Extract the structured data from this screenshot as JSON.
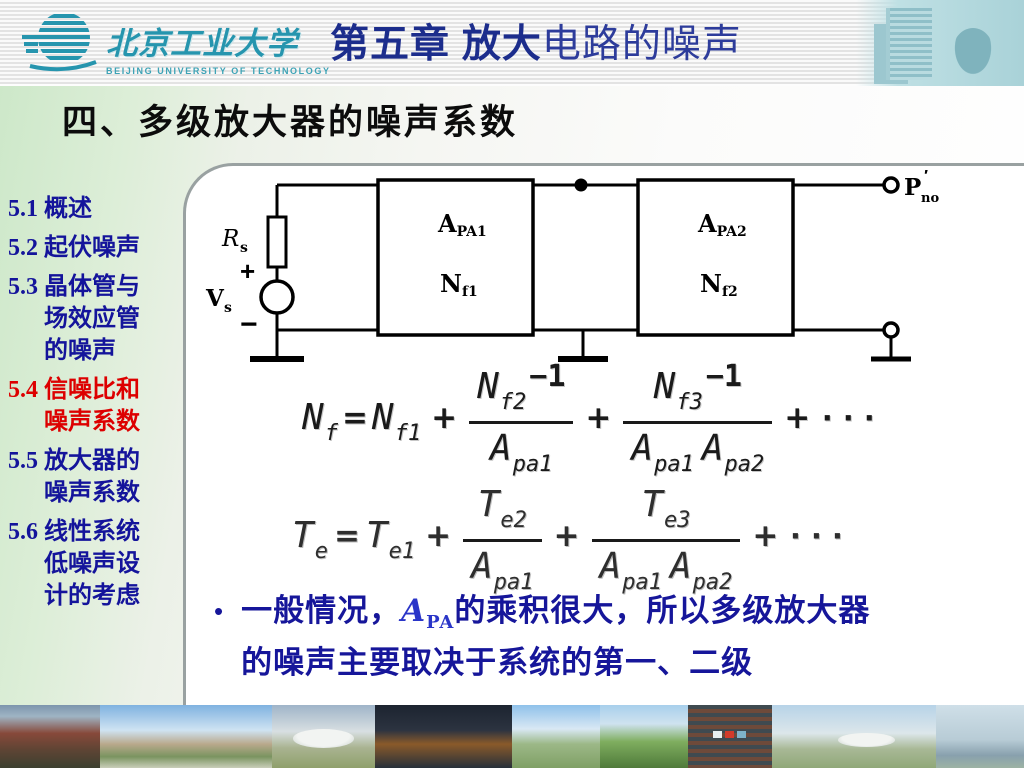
{
  "header": {
    "university_cn": "北京工业大学",
    "university_en": "BEIJING UNIVERSITY OF TECHNOLOGY",
    "chapter_title_bold": "第五章 放大",
    "chapter_title_rest": "电路的噪声"
  },
  "slide": {
    "title": "四、多级放大器的噪声系数"
  },
  "sidebar": {
    "normal_color": "#14149b",
    "active_color": "#dd0000",
    "items": [
      {
        "num": "5.1",
        "lines": [
          "概述"
        ],
        "active": false
      },
      {
        "num": "5.2",
        "lines": [
          "起伏噪声"
        ],
        "active": false
      },
      {
        "num": "5.3",
        "lines": [
          "晶体管与",
          "场效应管",
          "的噪声"
        ],
        "active": false
      },
      {
        "num": "5.4",
        "lines": [
          "信噪比和",
          "噪声系数"
        ],
        "active": true
      },
      {
        "num": "5.5",
        "lines": [
          "放大器的",
          "噪声系数"
        ],
        "active": false
      },
      {
        "num": "5.6",
        "lines": [
          "线性系统",
          "低噪声设",
          "计的考虑"
        ],
        "active": false
      }
    ]
  },
  "circuit": {
    "rs": "R",
    "rs_sub": "s",
    "vs": "V",
    "vs_sub": "s",
    "plus": "+",
    "minus": "−",
    "amp1_gain": "A",
    "amp1_gain_sub": "PA1",
    "amp1_nf": "N",
    "amp1_nf_sub": "f1",
    "amp2_gain": "A",
    "amp2_gain_sub": "PA2",
    "amp2_nf": "N",
    "amp2_nf_sub": "f2",
    "out": "P",
    "out_prime": "′",
    "out_sub": "no"
  },
  "formulas": {
    "nf": {
      "lhs": "N",
      "lhs_sub": "f",
      "eq": "=",
      "t1": "N",
      "t1_sub": "f1",
      "op1": "+",
      "n2": "N",
      "n2_sub": "f2",
      "n2_tail": "−1",
      "d2": "A",
      "d2_sub": "pa1",
      "op2": "+",
      "n3": "N",
      "n3_sub": "f3",
      "n3_tail": "−1",
      "d3a": "A",
      "d3a_sub": "pa1",
      "d3b": "A",
      "d3b_sub": "pa2",
      "op3": "+",
      "dots": "···"
    },
    "te": {
      "lhs": "T",
      "lhs_sub": "e",
      "eq": "=",
      "t1": "T",
      "t1_sub": "e1",
      "op1": "+",
      "n2": "T",
      "n2_sub": "e2",
      "d2": "A",
      "d2_sub": "pa1",
      "op2": "+",
      "n3": "T",
      "n3_sub": "e3",
      "d3a": "A",
      "d3a_sub": "pa1",
      "d3b": "A",
      "d3b_sub": "pa2",
      "op3": "+",
      "dots": "···"
    }
  },
  "bullet": {
    "marker": "•",
    "prefix": "一般情况，",
    "var": "A",
    "var_sub": "PA",
    "suffix1": "的乘积很大，所以多级放大器",
    "line2": "的噪声主要取决于系统的第一、二级"
  }
}
